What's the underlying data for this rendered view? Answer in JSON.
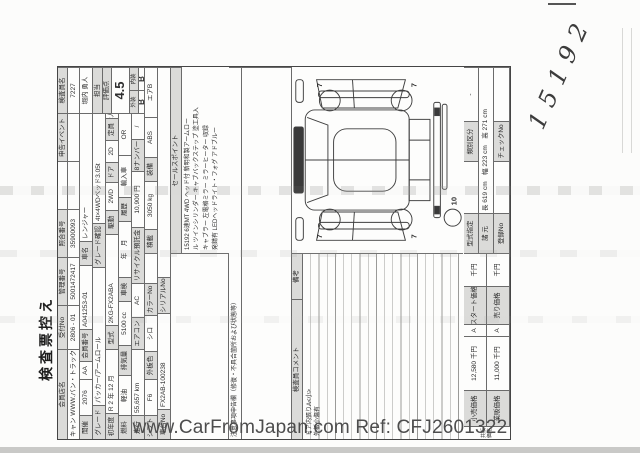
{
  "title": "検査票控え",
  "handwritten_number": "15192",
  "watermark": "www.CarFromJapan.com Ref: CFJ2601322",
  "header": {
    "member_store": {
      "label": "会員店名",
      "value": "キャン WWW.バン・トラック.jp"
    },
    "reception_no": {
      "label": "受付No",
      "value": "2806 - 01"
    },
    "control_no": {
      "label": "管理番号",
      "value": "5001472417"
    },
    "reference_no": {
      "label": "照合番号",
      "value": "35900093"
    },
    "event": {
      "label": "申告イベント",
      "value": ""
    },
    "inspector": {
      "label": "検査員名",
      "id": "7227",
      "name": "堀内 勇人"
    },
    "in_charge": {
      "label": "担当"
    },
    "score": {
      "label": "評価点",
      "value": "4.5"
    },
    "exterior": {
      "label": "外装",
      "value": "B"
    },
    "interior": {
      "label": "内装",
      "value": "B"
    }
  },
  "vehicle": {
    "auction": {
      "label": "開催",
      "value": "2076",
      "sub": "AA"
    },
    "member_no": {
      "label": "会員番号",
      "value": "A041253-01"
    },
    "car_name": {
      "label": "車名",
      "value": "レンジャー"
    },
    "grade": {
      "label": "グレード",
      "value": "パッカー/アームロール"
    },
    "grade_check": {
      "label": "グレード確認",
      "value": "4t×4WDベッド3.05t"
    },
    "first_year": {
      "label": "初年度",
      "value": "R 2 年 12 月"
    },
    "model_code": {
      "label": "型式",
      "value": "2KG-FX2ABA"
    },
    "drive": {
      "label": "駆動",
      "value": "2WD"
    },
    "doors": {
      "label": "ドア",
      "value": "2D"
    },
    "capacity": {
      "label": "定員",
      "value": "2人"
    },
    "fuel": {
      "label": "燃料",
      "value": "軽油"
    },
    "displacement": {
      "label": "排気量",
      "value": "5100 cc"
    },
    "inspection": {
      "label": "車検",
      "value": "年　月"
    },
    "history": {
      "label": "履歴",
      "value": "輸入車",
      "sub": "OR"
    },
    "mileage": {
      "label": "走行",
      "value": "55,657 km"
    },
    "aircon": {
      "label": "エアコン",
      "value": "AC"
    },
    "recycle_fee": {
      "label": "リサイクル預託金",
      "value": "10,900 円"
    },
    "number8": {
      "label": "8ナンバー",
      "value": "/"
    },
    "shift": {
      "label": "シフト",
      "value": "F6"
    },
    "color": {
      "label": "外板色",
      "value": "シロ"
    },
    "color_no": {
      "label": "カラーNo",
      "value": ""
    },
    "payload": {
      "label": "積載",
      "value": "3050 kg"
    },
    "equipment": {
      "label": "装備",
      "items": [
        "ABS",
        "エアB"
      ]
    },
    "chassis_no": {
      "label": "車台No",
      "value": "FX2AB-100238"
    },
    "serial_no": {
      "label": "シリアルNo",
      "value": ""
    }
  },
  "sales_point": {
    "label": "セールスポイント",
    "lines": [
      "15192 6速MT 4WD ヘッド付 新明和製アームロー",
      "ル ツインシリンダー キャブバックステップ 塗工具入",
      "キャブラー 左電格ミラー ミラーヒーター 収録",
      "発錆有 LEDヘッドライト・フォグ アドブルー"
    ]
  },
  "notice": {
    "label": "注意事項申告欄（修復・不具合箇所および状態等）"
  },
  "comments": {
    "label": "検査員コメント",
    "remarks_label": "備考",
    "lines": [
      "ドア内張りA<小>",
      "外板小傷有"
    ]
  },
  "diagram": {
    "wheel_marks": [
      "7",
      "7",
      "7",
      "7"
    ],
    "spare_mark": "10"
  },
  "specs": {
    "type_designation": "型式指定",
    "class_division": "類別区分",
    "class_value": "-",
    "dims_label": "諸 元",
    "dims_value": "長 619 cm　幅 223 cm　高 271 cm",
    "registration_label": "登録No",
    "check_label": "チェックNo"
  },
  "prices": {
    "group_label": "共販価格",
    "retail": {
      "label": "小売価格",
      "value": "12,580 千円",
      "mark": "A"
    },
    "wholesale": {
      "label": "業販価格",
      "value": "11,000 千円",
      "mark": "A"
    },
    "start": {
      "label": "スタート価格",
      "unit": "千円"
    },
    "sell": {
      "label": "売り価格",
      "unit": "千円"
    }
  }
}
